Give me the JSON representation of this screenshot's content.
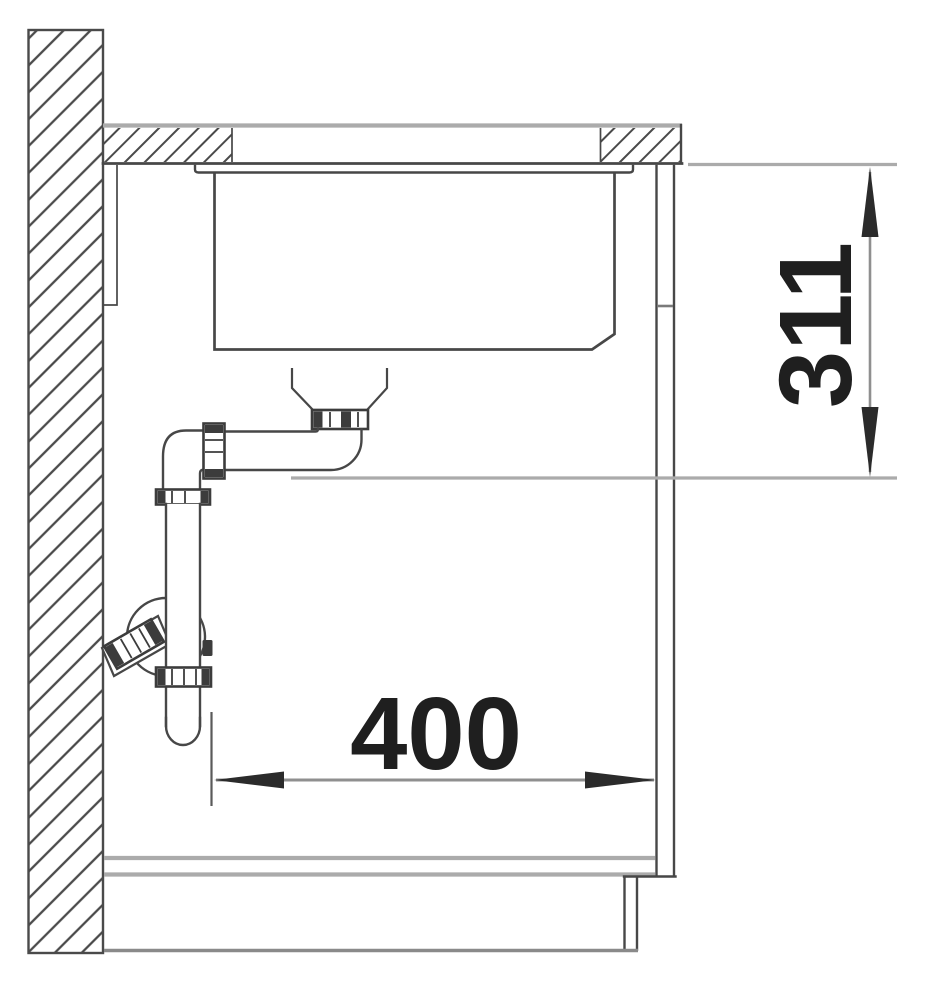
{
  "drawing": {
    "dimensions": {
      "vertical": {
        "value": "311",
        "orientation": "vertical",
        "position": "right"
      },
      "horizontal": {
        "value": "400",
        "orientation": "horizontal",
        "position": "bottom"
      }
    },
    "colors": {
      "ink": "#474747",
      "line-gray": "#ababab",
      "dim-gray": "#8f8f8f",
      "nut-dark": "#3c3c3c",
      "arrow": "#2b2b2b",
      "label": "#1f1f1f",
      "background": "#ffffff"
    }
  }
}
